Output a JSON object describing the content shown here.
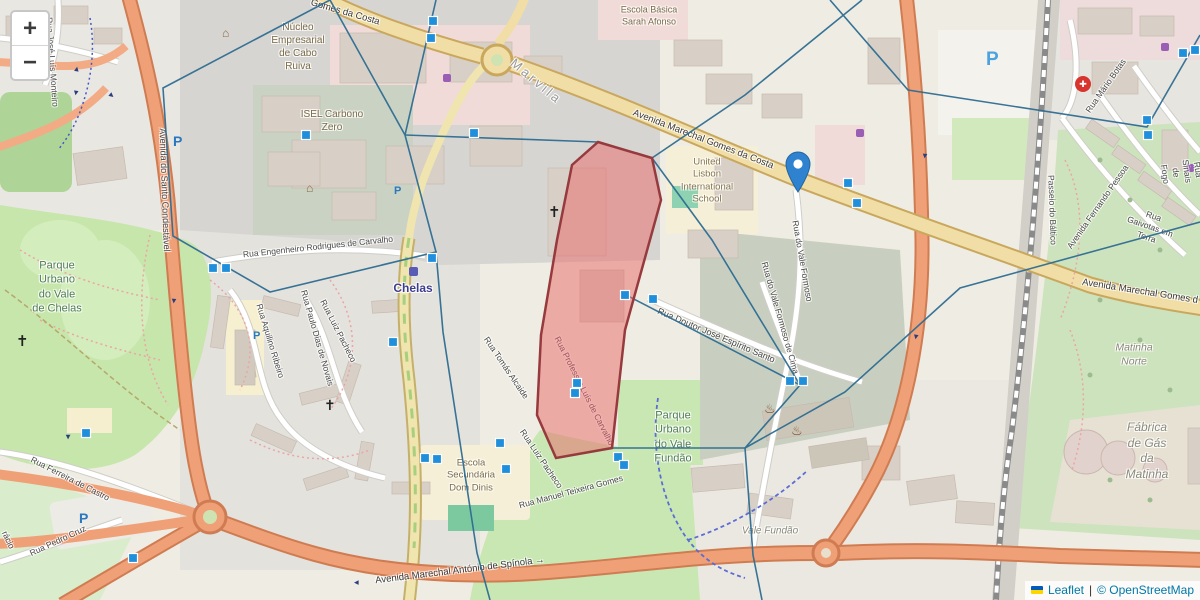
{
  "attribution": {
    "flag_icon": "ukraine-flag",
    "leaflet_link": "Leaflet",
    "separator": "|",
    "osm_credit": "© OpenStreetMap"
  },
  "zoom_controls": {
    "zoom_in": "+",
    "zoom_out": "−"
  },
  "labels": {
    "rua_jose_luis_monteiro": "Rua José Luís Monteiro",
    "av_santo_condestavel": "Avenida do Santo Condestável",
    "parque_chelas": "Parque\nUrbano\ndo Vale\nde Chelas",
    "nucleo_empresarial": "Núcleo\nEmpresarial\nde Cabo\nRuiva",
    "isel": "ISEL Carbono\nZero",
    "gomes_top": "Gomes da Costa",
    "gomes_main": "Avenida Marechal Gomes da Costa",
    "gomes_right": "Avenida Marechal Gomes d",
    "marvila": "Marvila",
    "sarah_afonso": "Escola Básica\nSarah Afonso",
    "united_lisbon": "United\nLisbon\nInternational\nSchool",
    "eng_rodrigues": "Rua Engenheiro Rodrigues de Carvalho",
    "chelas": "Chelas",
    "doutor_jose": "Rua Doutor José Espírito Santo",
    "prof_luis": "Rua Professor Luís de Carvalho",
    "tomas_alcaide": "Rua Tomás Alcaide",
    "luiz_pacheco": "Rua Luiz Pacheco",
    "aquilino": "Rua Aquilino Ribeiro",
    "paulo_dias": "Rua Paulo Dias de Novais",
    "ferreira_castro": "Rua Ferreira de Castro",
    "pedro_cruz": "Rua Pedro Cruz",
    "racio": "rácio",
    "dom_dinis": "Escola\nSecundária\nDom Dinis",
    "manuel_teixeira": "Rua Manuel Teixeira Gomes",
    "parque_fundao": "Parque\nUrbano\ndo Vale\nFundão",
    "vale_fundao": "Vale Fundão",
    "spinola": "Avenida Marechal António de Spínola →",
    "matinha_norte": "Matinha\nNorte",
    "fabrica_gas": "Fábrica\nde Gás\nda Matinha",
    "mario_botas": "Rua Mário Botas",
    "passeio_baltico": "Passeio do Báltico",
    "fernando_pessoa": "Avenida Fernando Pessoa",
    "gaivotas": "Rua Gaivotas em Terra",
    "sinais_fogo": "Rua Sinais de Fogo",
    "vale_formoso": "Rua do Vale Formoso",
    "vale_formoso_cima": "Rua do Vale Formoso de Cima"
  },
  "icons": {
    "church": "✝",
    "parking": "P",
    "hospital_cross": "✚",
    "flame": "♨",
    "civic_building": "⌂",
    "oneway_arrow": "▶"
  },
  "colors": {
    "mesh_line": "#2e6d92",
    "vertex_handle": "#1f8fdc",
    "zone_fill": "rgba(233,103,103,0.5)",
    "zone_border": "#963a3e",
    "marker_blue": "#2e82cf",
    "primary_road": "#f0a077",
    "avenue_yellow": "#f1dea6",
    "park_green": "#c7e6ab",
    "leaflet_link_blue": "#0078A8"
  }
}
